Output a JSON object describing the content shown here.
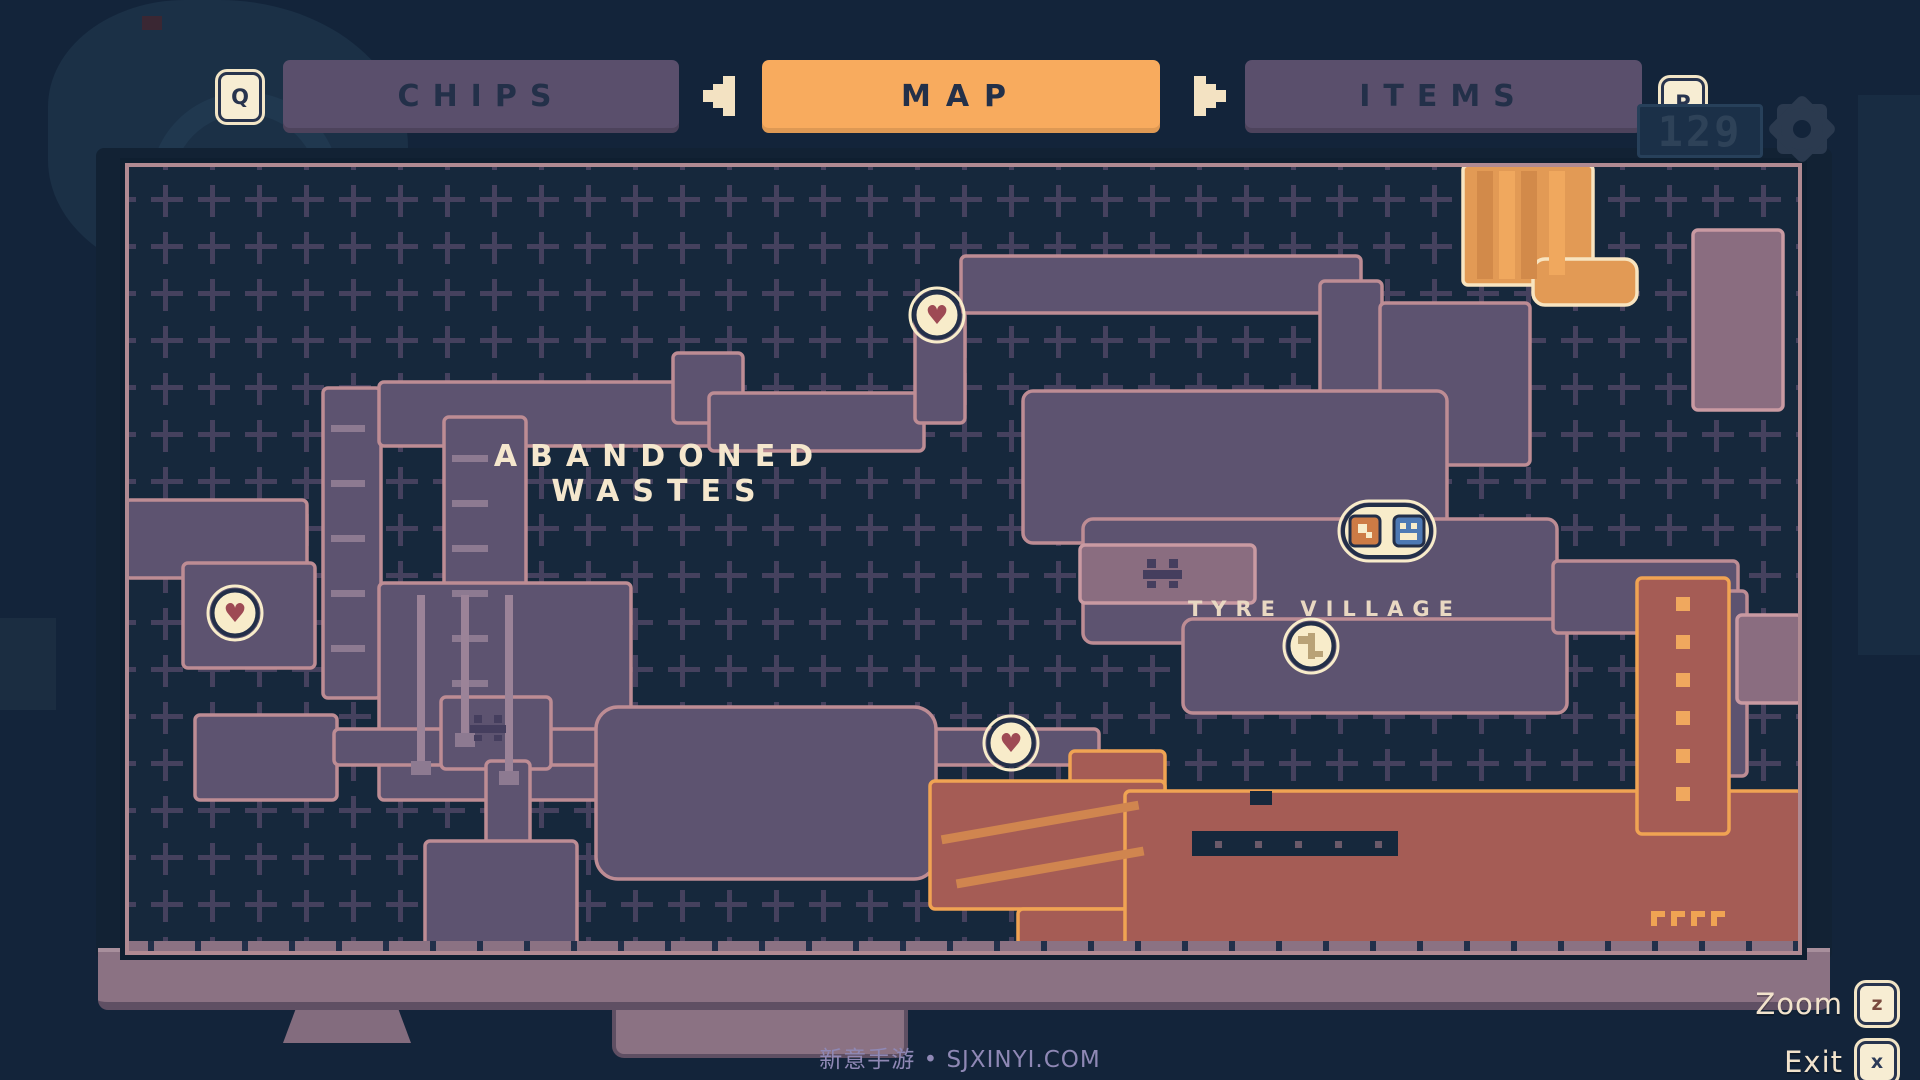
{
  "tabs": {
    "chips_label": "CHIPS",
    "map_label": "MAP",
    "items_label": "ITEMS",
    "prev_key": "Q",
    "next_key": "P"
  },
  "hud": {
    "counter": "129"
  },
  "map": {
    "region_label": "ABANDONED WASTES",
    "village_label": "TYRE VILLAGE",
    "zoom_label": "Zoom",
    "zoom_key": "z",
    "exit_label": "Exit",
    "exit_key": "x"
  },
  "watermark": "新意手游 • SJXINYI.COM",
  "colors": {
    "bg": "#16283c",
    "grid": "#474260",
    "purpleRoom": "#5d5370",
    "roomStroke": "#bd8c94",
    "lightRoom": "#8a6d80",
    "lightStroke": "#c99aa2",
    "orange": "#e29a55",
    "orangeStripeDark": "#d28a4a",
    "orangeStripeLight": "#f0a85e",
    "cream": "#f8e4c0",
    "red": "#a55c55",
    "redStroke": "#f0a353",
    "redStripe": "#d0854f",
    "mauve": "#8b7283",
    "tick": "#22304a",
    "decor": "#8d7a91",
    "pipe": "#9b8398",
    "face": "#453e5e",
    "insetDot": "#6b5a6a",
    "badgeFill": "#f8ecca",
    "badgeRing": "#232f49",
    "heart": "#9e4a54",
    "keyGlyph": "#b9a277",
    "orangeIcon": "#cd7b45",
    "blueIcon": "#4d79b4",
    "mapBorder": "#b08a92",
    "tabActive": "#f8ab5e",
    "tabInactive": "#5a4f6c"
  },
  "map_shapes": {
    "rooms": [
      {
        "x": 198,
        "y": 225,
        "w": 58,
        "h": 310
      },
      {
        "x": 254,
        "y": 219,
        "w": 336,
        "h": 64
      },
      {
        "x": 548,
        "y": 190,
        "w": 70,
        "h": 70
      },
      {
        "x": 584,
        "y": 230,
        "w": 215,
        "h": 58
      },
      {
        "x": 790,
        "y": 148,
        "w": 50,
        "h": 112
      },
      {
        "x": 836,
        "y": 93,
        "w": 400,
        "h": 57
      },
      {
        "x": 1195,
        "y": 118,
        "w": 62,
        "h": 190
      },
      {
        "x": 1255,
        "y": 140,
        "w": 150,
        "h": 162
      },
      {
        "x": 319,
        "y": 254,
        "w": 82,
        "h": 315
      },
      {
        "x": 0,
        "y": 337,
        "w": 182,
        "h": 78
      },
      {
        "x": 58,
        "y": 400,
        "w": 132,
        "h": 105
      },
      {
        "x": 254,
        "y": 420,
        "w": 252,
        "h": 217
      },
      {
        "x": 70,
        "y": 552,
        "w": 142,
        "h": 85
      },
      {
        "x": 209,
        "y": 566,
        "w": 765,
        "h": 36
      },
      {
        "x": 316,
        "y": 534,
        "w": 110,
        "h": 72
      },
      {
        "x": 361,
        "y": 598,
        "w": 44,
        "h": 88
      },
      {
        "x": 300,
        "y": 678,
        "w": 152,
        "h": 114
      },
      {
        "x": 471,
        "y": 544,
        "w": 340,
        "h": 172,
        "rx": 22
      },
      {
        "x": 898,
        "y": 228,
        "w": 424,
        "h": 152,
        "rx": 10
      },
      {
        "x": 958,
        "y": 356,
        "w": 474,
        "h": 124,
        "rx": 10
      },
      {
        "x": 1058,
        "y": 456,
        "w": 384,
        "h": 94,
        "rx": 10
      },
      {
        "x": 1428,
        "y": 398,
        "w": 185,
        "h": 72
      },
      {
        "x": 1538,
        "y": 428,
        "w": 84,
        "h": 185
      },
      {
        "x": 1568,
        "y": 67,
        "w": 90,
        "h": 180,
        "f": "lightRoom",
        "s": "lightStroke"
      },
      {
        "x": 1612,
        "y": 452,
        "w": 65,
        "h": 88,
        "f": "lightRoom",
        "s": "lightStroke"
      },
      {
        "x": 955,
        "y": 382,
        "w": 175,
        "h": 58,
        "f": "lightRoom",
        "s": "lightStroke"
      },
      {
        "x": 1338,
        "y": 2,
        "w": 130,
        "h": 120,
        "f": "orange",
        "s": "cream"
      },
      {
        "x": 1408,
        "y": 96,
        "w": 104,
        "h": 46,
        "f": "orange",
        "s": "cream",
        "rx": 12
      },
      {
        "x": 945,
        "y": 588,
        "w": 95,
        "h": 70,
        "f": "red",
        "s": "redStroke"
      },
      {
        "x": 805,
        "y": 618,
        "w": 235,
        "h": 128,
        "f": "red",
        "s": "redStroke"
      },
      {
        "x": 893,
        "y": 746,
        "w": 148,
        "h": 38,
        "f": "red",
        "s": "redStroke"
      },
      {
        "x": 1000,
        "y": 628,
        "w": 677,
        "h": 164,
        "f": "red",
        "s": "redStroke"
      },
      {
        "x": 1512,
        "y": 415,
        "w": 92,
        "h": 256,
        "f": "red",
        "s": "redStroke"
      }
    ],
    "decor": [
      {
        "x": 206,
        "y": 262,
        "w": 34,
        "h": 7,
        "f": "decor"
      },
      {
        "x": 206,
        "y": 317,
        "w": 34,
        "h": 7,
        "f": "decor"
      },
      {
        "x": 206,
        "y": 372,
        "w": 34,
        "h": 7,
        "f": "decor"
      },
      {
        "x": 206,
        "y": 427,
        "w": 34,
        "h": 7,
        "f": "decor"
      },
      {
        "x": 206,
        "y": 482,
        "w": 34,
        "h": 7,
        "f": "decor"
      },
      {
        "x": 327,
        "y": 292,
        "w": 36,
        "h": 7,
        "f": "decor"
      },
      {
        "x": 327,
        "y": 337,
        "w": 36,
        "h": 7,
        "f": "decor"
      },
      {
        "x": 327,
        "y": 382,
        "w": 36,
        "h": 7,
        "f": "decor"
      },
      {
        "x": 327,
        "y": 427,
        "w": 36,
        "h": 7,
        "f": "decor"
      },
      {
        "x": 327,
        "y": 472,
        "w": 36,
        "h": 7,
        "f": "decor"
      },
      {
        "x": 327,
        "y": 517,
        "w": 36,
        "h": 7,
        "f": "decor"
      },
      {
        "x": 292,
        "y": 432,
        "w": 8,
        "h": 178,
        "f": "pipe"
      },
      {
        "x": 336,
        "y": 432,
        "w": 8,
        "h": 150,
        "f": "pipe"
      },
      {
        "x": 380,
        "y": 432,
        "w": 8,
        "h": 188,
        "f": "pipe"
      },
      {
        "x": 286,
        "y": 598,
        "w": 20,
        "h": 14,
        "f": "decor"
      },
      {
        "x": 330,
        "y": 570,
        "w": 20,
        "h": 14,
        "f": "decor"
      },
      {
        "x": 374,
        "y": 608,
        "w": 20,
        "h": 14,
        "f": "decor"
      },
      {
        "x": 1352,
        "y": 8,
        "w": 16,
        "h": 108,
        "f": "orangeStripeDark"
      },
      {
        "x": 1374,
        "y": 8,
        "w": 16,
        "h": 108,
        "f": "orangeStripeLight"
      },
      {
        "x": 1396,
        "y": 8,
        "w": 16,
        "h": 108,
        "f": "orangeStripeDark"
      },
      {
        "x": 1424,
        "y": 8,
        "w": 16,
        "h": 104,
        "f": "orangeStripeLight"
      },
      {
        "x": 815,
        "y": 655,
        "w": 200,
        "h": 9,
        "f": "redStripe",
        "tr": "rotate(-10 915 659)"
      },
      {
        "x": 830,
        "y": 700,
        "w": 190,
        "h": 9,
        "f": "redStripe",
        "tr": "rotate(-10 925 704)"
      },
      {
        "x": 1125,
        "y": 628,
        "w": 22,
        "h": 14,
        "f": "bg"
      },
      {
        "x": 1067,
        "y": 668,
        "w": 206,
        "h": 25,
        "f": "bg"
      },
      {
        "x": 1090,
        "y": 678,
        "w": 7,
        "h": 7,
        "f": "insetDot"
      },
      {
        "x": 1130,
        "y": 678,
        "w": 7,
        "h": 7,
        "f": "insetDot"
      },
      {
        "x": 1170,
        "y": 678,
        "w": 7,
        "h": 7,
        "f": "insetDot"
      },
      {
        "x": 1210,
        "y": 678,
        "w": 7,
        "h": 7,
        "f": "insetDot"
      },
      {
        "x": 1250,
        "y": 678,
        "w": 7,
        "h": 7,
        "f": "insetDot"
      },
      {
        "x": 1551,
        "y": 434,
        "w": 14,
        "h": 14,
        "f": "orangeStripeLight"
      },
      {
        "x": 1551,
        "y": 472,
        "w": 14,
        "h": 14,
        "f": "orangeStripeLight"
      },
      {
        "x": 1551,
        "y": 510,
        "w": 14,
        "h": 14,
        "f": "orangeStripeLight"
      },
      {
        "x": 1551,
        "y": 548,
        "w": 14,
        "h": 14,
        "f": "orangeStripeLight"
      },
      {
        "x": 1551,
        "y": 586,
        "w": 14,
        "h": 14,
        "f": "orangeStripeLight"
      },
      {
        "x": 1551,
        "y": 624,
        "w": 14,
        "h": 14,
        "f": "orangeStripeLight"
      },
      {
        "x": 1526,
        "y": 748,
        "w": 14,
        "h": 6,
        "f": "redStroke"
      },
      {
        "x": 1546,
        "y": 748,
        "w": 14,
        "h": 6,
        "f": "redStroke"
      },
      {
        "x": 1566,
        "y": 748,
        "w": 14,
        "h": 6,
        "f": "redStroke"
      },
      {
        "x": 1586,
        "y": 748,
        "w": 14,
        "h": 6,
        "f": "redStroke"
      },
      {
        "x": 1526,
        "y": 754,
        "w": 6,
        "h": 9,
        "f": "redStroke"
      },
      {
        "x": 1546,
        "y": 754,
        "w": 6,
        "h": 9,
        "f": "redStroke"
      },
      {
        "x": 1566,
        "y": 754,
        "w": 6,
        "h": 9,
        "f": "redStroke"
      },
      {
        "x": 1586,
        "y": 754,
        "w": 6,
        "h": 9,
        "f": "redStroke"
      },
      {
        "x": 1022,
        "y": 396,
        "w": 9,
        "h": 9,
        "f": "face"
      },
      {
        "x": 1044,
        "y": 396,
        "w": 9,
        "h": 9,
        "f": "face"
      },
      {
        "x": 1018,
        "y": 407,
        "w": 39,
        "h": 9,
        "f": "face"
      },
      {
        "x": 1022,
        "y": 418,
        "w": 9,
        "h": 7,
        "f": "face"
      },
      {
        "x": 1044,
        "y": 418,
        "w": 9,
        "h": 7,
        "f": "face"
      },
      {
        "x": 349,
        "y": 552,
        "w": 8,
        "h": 8,
        "f": "face"
      },
      {
        "x": 369,
        "y": 552,
        "w": 8,
        "h": 8,
        "f": "face"
      },
      {
        "x": 345,
        "y": 562,
        "w": 36,
        "h": 8,
        "f": "face"
      },
      {
        "x": 349,
        "y": 572,
        "w": 8,
        "h": 6,
        "f": "face"
      },
      {
        "x": 369,
        "y": 572,
        "w": 8,
        "h": 6,
        "f": "face"
      }
    ],
    "icons": [
      {
        "t": "heart",
        "x": 812,
        "y": 152
      },
      {
        "t": "heart",
        "x": 110,
        "y": 450
      },
      {
        "t": "heart",
        "x": 886,
        "y": 580
      },
      {
        "t": "key",
        "x": 1186,
        "y": 483
      },
      {
        "t": "twin",
        "x": 1262,
        "y": 368
      }
    ]
  }
}
